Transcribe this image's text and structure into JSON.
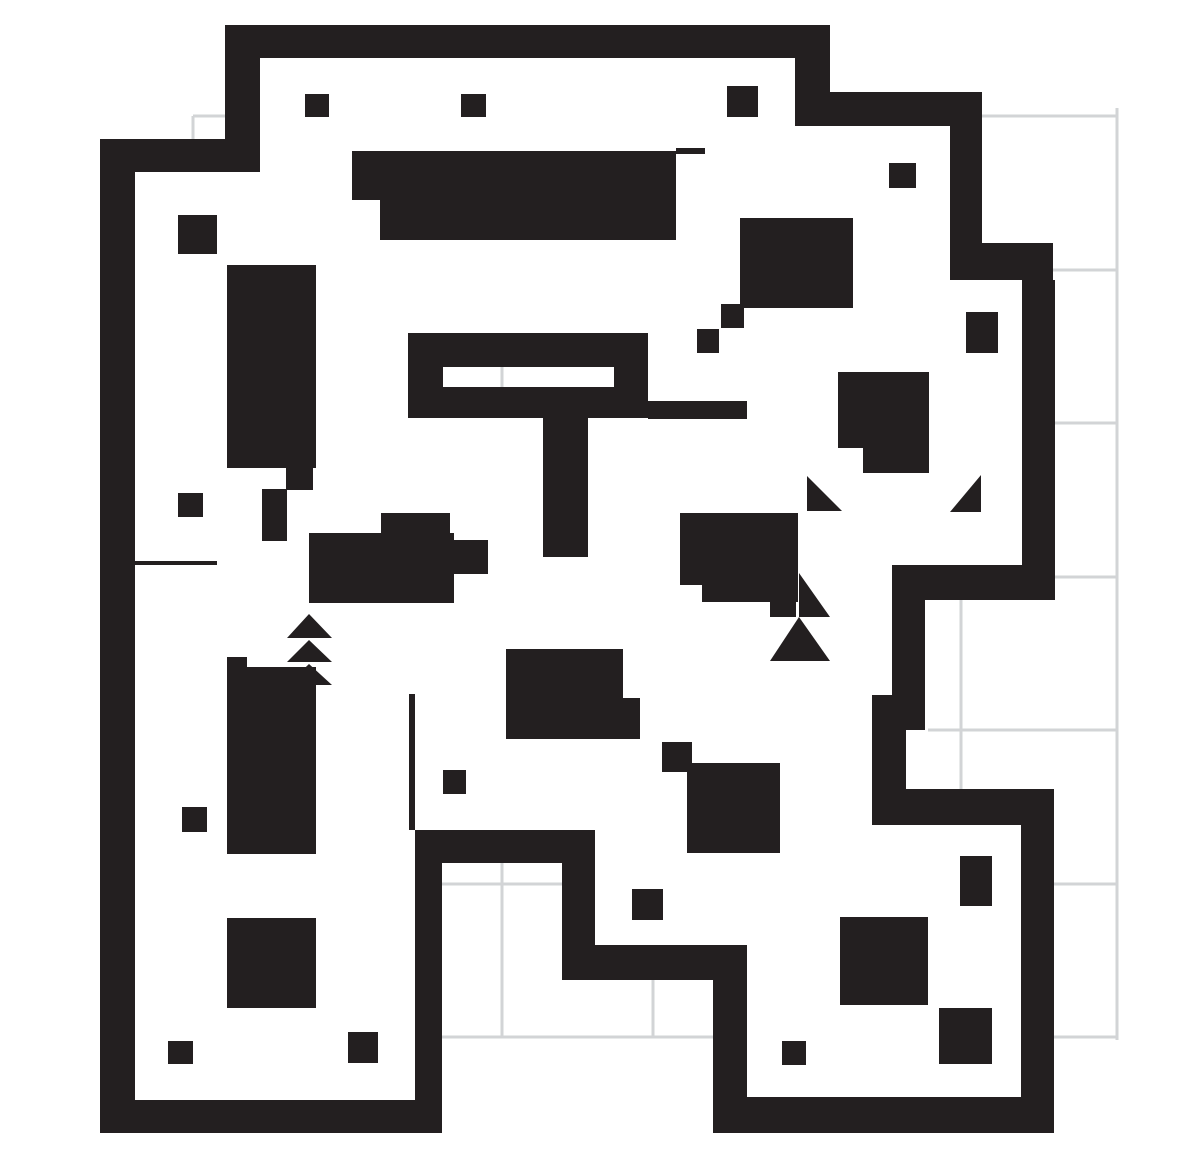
{
  "canvas": {
    "width": 1177,
    "height": 1168,
    "background_color": "#ffffff"
  },
  "palette": {
    "wall_color": "#231f20",
    "grid_color": "#d2d4d6",
    "floor_color": "#ffffff"
  },
  "grid_lines": {
    "stroke_width": 3,
    "horizontal": [
      {
        "y": 116,
        "x1": 193,
        "x2": 226
      },
      {
        "y": 116,
        "x1": 978,
        "x2": 1118
      },
      {
        "y": 270,
        "x1": 1053,
        "x2": 1118
      },
      {
        "y": 423,
        "x1": 1055,
        "x2": 1118
      },
      {
        "y": 577,
        "x1": 1055,
        "x2": 1118
      },
      {
        "y": 730,
        "x1": 928,
        "x2": 1118
      },
      {
        "y": 884,
        "x1": 442,
        "x2": 562
      },
      {
        "y": 884,
        "x1": 1054,
        "x2": 1118
      },
      {
        "y": 1037,
        "x1": 442,
        "x2": 713
      },
      {
        "y": 1037,
        "x1": 1054,
        "x2": 1118
      }
    ],
    "vertical": [
      {
        "x": 193,
        "y1": 116,
        "y2": 140
      },
      {
        "x": 502,
        "y1": 367,
        "y2": 390
      },
      {
        "x": 502,
        "y1": 863,
        "y2": 1038
      },
      {
        "x": 653,
        "y1": 980,
        "y2": 1038
      },
      {
        "x": 961,
        "y1": 600,
        "y2": 789
      },
      {
        "x": 1117,
        "y1": 108,
        "y2": 1040
      }
    ]
  },
  "walls": [
    {
      "x": 225,
      "y": 25,
      "w": 605,
      "h": 33
    },
    {
      "x": 225,
      "y": 25,
      "w": 35,
      "h": 147
    },
    {
      "x": 100,
      "y": 139,
      "w": 160,
      "h": 33
    },
    {
      "x": 100,
      "y": 139,
      "w": 35,
      "h": 994
    },
    {
      "x": 100,
      "y": 1100,
      "w": 342,
      "h": 33
    },
    {
      "x": 795,
      "y": 58,
      "w": 35,
      "h": 68
    },
    {
      "x": 795,
      "y": 92,
      "w": 187,
      "h": 34
    },
    {
      "x": 950,
      "y": 92,
      "w": 32,
      "h": 188
    },
    {
      "x": 978,
      "y": 243,
      "w": 75,
      "h": 37
    },
    {
      "x": 1022,
      "y": 280,
      "w": 33,
      "h": 320
    },
    {
      "x": 892,
      "y": 565,
      "w": 163,
      "h": 35
    },
    {
      "x": 892,
      "y": 600,
      "w": 33,
      "h": 95
    },
    {
      "x": 872,
      "y": 695,
      "w": 53,
      "h": 35
    },
    {
      "x": 872,
      "y": 730,
      "w": 34,
      "h": 59
    },
    {
      "x": 872,
      "y": 789,
      "w": 182,
      "h": 36
    },
    {
      "x": 1021,
      "y": 825,
      "w": 33,
      "h": 308
    },
    {
      "x": 713,
      "y": 1097,
      "w": 341,
      "h": 36
    },
    {
      "x": 713,
      "y": 980,
      "w": 34,
      "h": 120
    },
    {
      "x": 562,
      "y": 945,
      "w": 185,
      "h": 35
    },
    {
      "x": 562,
      "y": 863,
      "w": 33,
      "h": 82
    },
    {
      "x": 415,
      "y": 830,
      "w": 180,
      "h": 33
    },
    {
      "x": 415,
      "y": 863,
      "w": 27,
      "h": 270
    },
    {
      "x": 409,
      "y": 694,
      "w": 6,
      "h": 136
    },
    {
      "x": 135,
      "y": 561,
      "w": 82,
      "h": 4
    },
    {
      "x": 676,
      "y": 148,
      "w": 29,
      "h": 6
    },
    {
      "x": 408,
      "y": 333,
      "w": 240,
      "h": 85
    },
    {
      "x": 543,
      "y": 418,
      "w": 45,
      "h": 139
    },
    {
      "x": 648,
      "y": 401,
      "w": 99,
      "h": 18
    }
  ],
  "floor_cutouts": [
    {
      "x": 443,
      "y": 367,
      "w": 171,
      "h": 20
    }
  ],
  "obstacles": [
    {
      "x": 352,
      "y": 151,
      "w": 324,
      "h": 49
    },
    {
      "x": 380,
      "y": 200,
      "w": 296,
      "h": 40
    },
    {
      "x": 740,
      "y": 218,
      "w": 113,
      "h": 90
    },
    {
      "x": 721,
      "y": 304,
      "w": 23,
      "h": 24
    },
    {
      "x": 697,
      "y": 329,
      "w": 22,
      "h": 24
    },
    {
      "x": 838,
      "y": 372,
      "w": 91,
      "h": 76
    },
    {
      "x": 863,
      "y": 448,
      "w": 66,
      "h": 25
    },
    {
      "x": 966,
      "y": 312,
      "w": 32,
      "h": 41
    },
    {
      "x": 305,
      "y": 94,
      "w": 24,
      "h": 23
    },
    {
      "x": 461,
      "y": 94,
      "w": 25,
      "h": 23
    },
    {
      "x": 727,
      "y": 86,
      "w": 31,
      "h": 31
    },
    {
      "x": 889,
      "y": 163,
      "w": 27,
      "h": 25
    },
    {
      "x": 178,
      "y": 215,
      "w": 39,
      "h": 39
    },
    {
      "x": 227,
      "y": 265,
      "w": 89,
      "h": 203
    },
    {
      "x": 286,
      "y": 468,
      "w": 27,
      "h": 22
    },
    {
      "x": 178,
      "y": 493,
      "w": 25,
      "h": 24
    },
    {
      "x": 262,
      "y": 489,
      "w": 25,
      "h": 52
    },
    {
      "x": 381,
      "y": 513,
      "w": 69,
      "h": 20
    },
    {
      "x": 309,
      "y": 533,
      "w": 145,
      "h": 70
    },
    {
      "x": 454,
      "y": 540,
      "w": 34,
      "h": 34
    },
    {
      "x": 680,
      "y": 513,
      "w": 118,
      "h": 72
    },
    {
      "x": 702,
      "y": 585,
      "w": 96,
      "h": 17
    },
    {
      "x": 770,
      "y": 602,
      "w": 26,
      "h": 15
    },
    {
      "x": 227,
      "y": 657,
      "w": 20,
      "h": 10
    },
    {
      "x": 227,
      "y": 667,
      "w": 89,
      "h": 187
    },
    {
      "x": 182,
      "y": 807,
      "w": 25,
      "h": 25
    },
    {
      "x": 227,
      "y": 918,
      "w": 89,
      "h": 90
    },
    {
      "x": 168,
      "y": 1041,
      "w": 25,
      "h": 23
    },
    {
      "x": 348,
      "y": 1032,
      "w": 30,
      "h": 31
    },
    {
      "x": 443,
      "y": 770,
      "w": 23,
      "h": 24
    },
    {
      "x": 506,
      "y": 649,
      "w": 117,
      "h": 90
    },
    {
      "x": 623,
      "y": 698,
      "w": 17,
      "h": 41
    },
    {
      "x": 632,
      "y": 889,
      "w": 31,
      "h": 31
    },
    {
      "x": 662,
      "y": 742,
      "w": 30,
      "h": 30
    },
    {
      "x": 687,
      "y": 763,
      "w": 93,
      "h": 90
    },
    {
      "x": 782,
      "y": 1041,
      "w": 24,
      "h": 24
    },
    {
      "x": 960,
      "y": 856,
      "w": 32,
      "h": 50
    },
    {
      "x": 840,
      "y": 917,
      "w": 88,
      "h": 88
    },
    {
      "x": 939,
      "y": 1008,
      "w": 53,
      "h": 56
    }
  ],
  "stair_arrows": [
    {
      "points": "287,638 309,614 332,638"
    },
    {
      "points": "287,662 309,640 332,662"
    },
    {
      "points": "287,685 309,664 332,685"
    }
  ],
  "corner_triangles": [
    {
      "points": "807,476 807,511 842,511"
    },
    {
      "points": "981,475 981,512 950,512"
    },
    {
      "points": "799,573 799,617 830,617"
    },
    {
      "points": "799,617 770,661 799,661"
    },
    {
      "points": "799,617 799,661 830,661"
    }
  ]
}
